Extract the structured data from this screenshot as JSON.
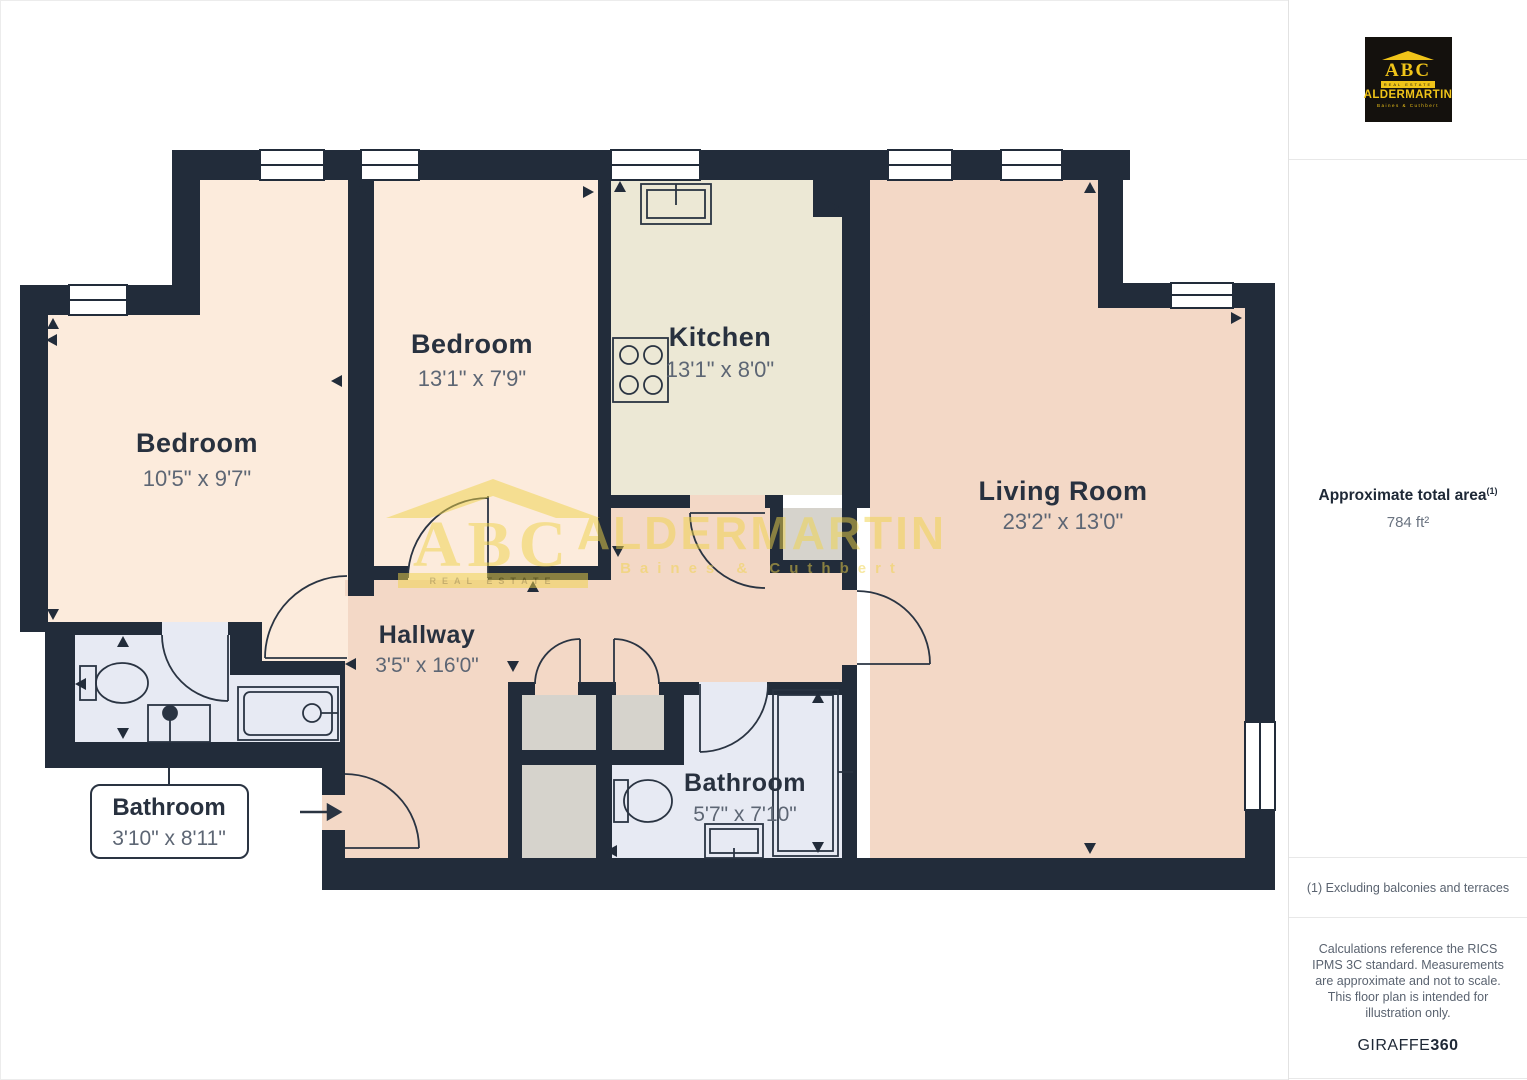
{
  "rooms": {
    "bedroom1": {
      "name": "Bedroom",
      "dims": "10'5\" x 9'7\""
    },
    "bedroom2": {
      "name": "Bedroom",
      "dims": "13'1\" x 7'9\""
    },
    "kitchen": {
      "name": "Kitchen",
      "dims": "13'1\" x 8'0\""
    },
    "living": {
      "name": "Living Room",
      "dims": "23'2\" x 13'0\""
    },
    "hallway": {
      "name": "Hallway",
      "dims": "3'5\" x 16'0\""
    },
    "bathroom2": {
      "name": "Bathroom",
      "dims": "5'7\" x 7'10\""
    },
    "bathroom1": {
      "name": "Bathroom",
      "dims": "3'10\" x 8'11\""
    }
  },
  "watermark": {
    "abc": "ABC",
    "estate": "REAL ESTATE",
    "name": "ALDERMARTIN",
    "sub": "Baines & Cuthbert"
  },
  "sidebar": {
    "logo": {
      "abc": "ABC",
      "estate": "REAL ESTATE",
      "name": "ALDERMARTIN",
      "sub": "Baines & Cuthbert"
    },
    "area_title": "Approximate total area",
    "area_sup": "(1)",
    "area_value": "784 ft²",
    "note1": "(1) Excluding balconies and terraces",
    "disclaimer": "Calculations reference the RICS IPMS 3C standard. Measurements are approximate and not to scale. This floor plan is intended for illustration only.",
    "brand": "GIRAFFE",
    "brand_bold": "360"
  },
  "colors": {
    "wall": "#222c3a",
    "bedroom": "#fcebdc",
    "kitchen": "#ece8d5",
    "living_hall": "#f3d8c6",
    "bathroom": "#e7eaf3",
    "closet": "#d6d3cc",
    "room_name": "#28313f",
    "room_dim": "#5d6674",
    "watermark_yellow": "#f0d348",
    "logo_yellow": "#f0c419",
    "logo_bg": "#14110d"
  }
}
